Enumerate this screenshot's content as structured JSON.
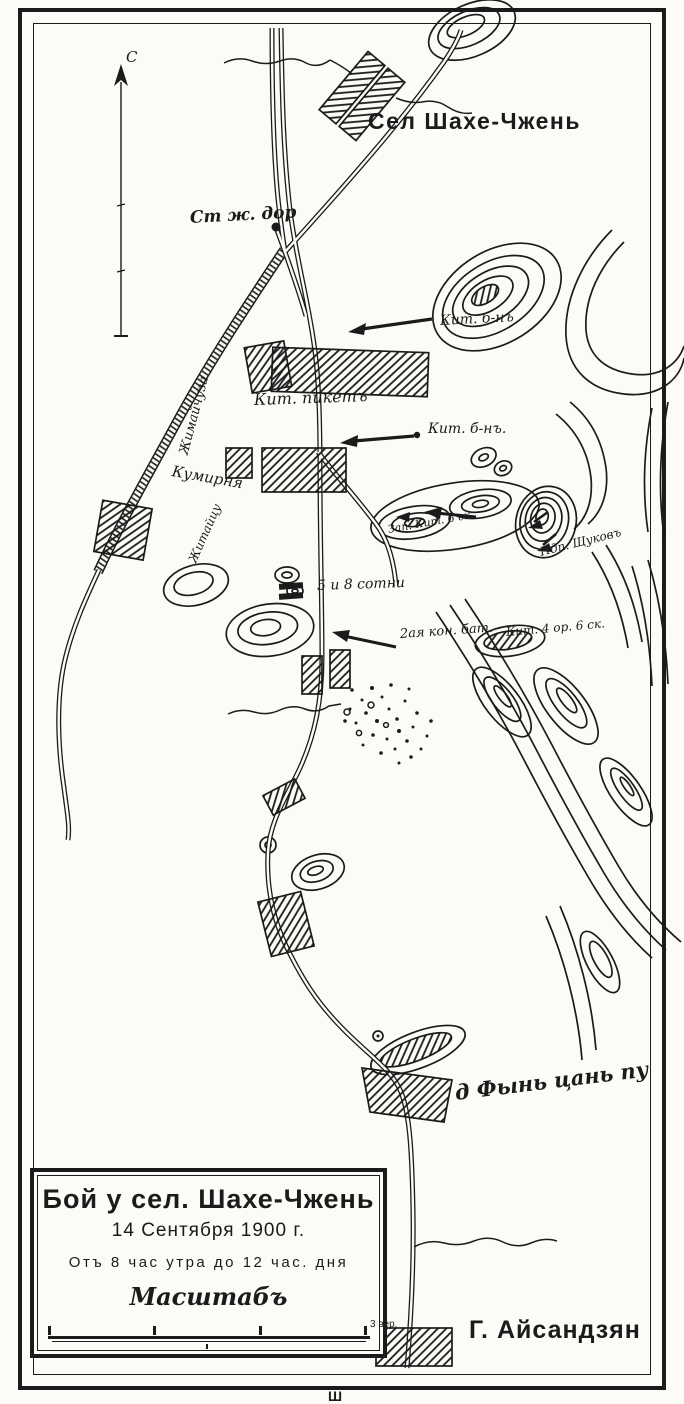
{
  "labels": {
    "north": "С",
    "station": "Ст ж. дор",
    "village_shahe": "Сел Шахе-Чжень",
    "kit_bn_top": "Кит. б-нъ",
    "kit_picket": "Кит. пикетъ",
    "kit_bn_mid": "Кит. б-нъ.",
    "kumirnya": "Кумирня",
    "railway_name": "Жимайчуза",
    "road_name": "Житайцу",
    "sotni": "5 и 8 сотни",
    "horse_battery": "2ая кон. бат.",
    "zap_hill": "Зап. Кит. 6 ск.",
    "shchukov": "Пдп. Щуковъ",
    "kit_hill": "Кит. 4 ор. 6 ск.",
    "fyn_tsan_pu": "д Фынь цань пу",
    "aisandzyan": "Г. Айсандзян",
    "footer_artifact": "Ш"
  },
  "title_block": {
    "title": "Бой у сел. Шахе-Чжень",
    "date": "14 Сентября 1900 г.",
    "time_range": "Отъ 8 час утра до 12 час. дня",
    "scale_label": "Масштабъ",
    "scale_unit": "3 вер."
  },
  "colors": {
    "ink": "#1b1b1b",
    "paper": "#fcfbf7"
  }
}
